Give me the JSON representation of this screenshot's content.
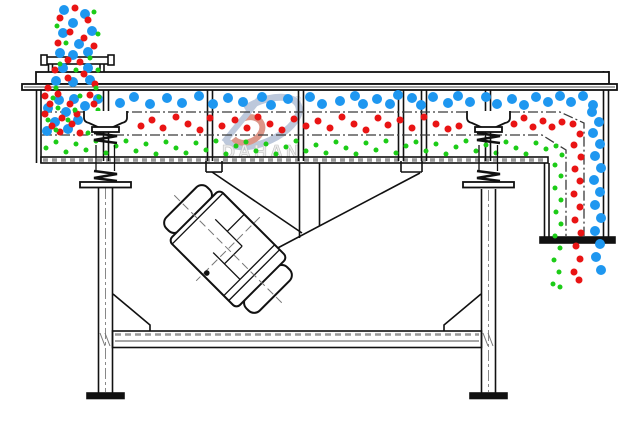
{
  "watermark": {
    "brand": "DAHAN",
    "registered_mark": "®"
  },
  "colors": {
    "blue": "#1e97f0",
    "red": "#e91414",
    "green": "#1ccc17",
    "line": "#111111",
    "hatch_gray": "#999999",
    "wm_blue": "#b6c3d8",
    "wm_red": "#d98b7c",
    "wm_text": "#ececec"
  },
  "particles": {
    "groups": [
      {
        "id": "feed-stream-blue",
        "color": "blue",
        "r": 5,
        "points": [
          [
            64,
            10
          ],
          [
            85,
            14
          ],
          [
            73,
            23
          ],
          [
            92,
            31
          ],
          [
            63,
            33
          ],
          [
            79,
            44
          ],
          [
            60,
            53
          ],
          [
            73,
            55
          ],
          [
            88,
            52
          ],
          [
            63,
            68
          ],
          [
            88,
            68
          ],
          [
            56,
            81
          ],
          [
            73,
            82
          ],
          [
            90,
            80
          ]
        ]
      },
      {
        "id": "feed-stream-red",
        "color": "red",
        "r": 3.5,
        "points": [
          [
            75,
            8
          ],
          [
            60,
            18
          ],
          [
            88,
            20
          ],
          [
            70,
            32
          ],
          [
            84,
            38
          ],
          [
            58,
            43
          ],
          [
            94,
            46
          ],
          [
            68,
            60
          ],
          [
            80,
            62
          ],
          [
            55,
            70
          ],
          [
            84,
            74
          ],
          [
            68,
            78
          ],
          [
            95,
            84
          ],
          [
            48,
            88
          ]
        ]
      },
      {
        "id": "feed-stream-green",
        "color": "green",
        "r": 2.5,
        "points": [
          [
            94,
            12
          ],
          [
            57,
            26
          ],
          [
            98,
            34
          ],
          [
            66,
            43
          ],
          [
            90,
            58
          ],
          [
            60,
            64
          ],
          [
            98,
            70
          ],
          [
            76,
            70
          ],
          [
            56,
            88
          ],
          [
            96,
            88
          ]
        ]
      },
      {
        "id": "feed-zone-blue",
        "color": "blue",
        "r": 5,
        "points": [
          [
            59,
            100
          ],
          [
            74,
            99
          ],
          [
            48,
            108
          ],
          [
            66,
            112
          ],
          [
            85,
            106
          ],
          [
            55,
            122
          ],
          [
            78,
            120
          ],
          [
            68,
            129
          ],
          [
            47,
            131
          ],
          [
            98,
            99
          ]
        ]
      },
      {
        "id": "feed-zone-red",
        "color": "red",
        "r": 3.5,
        "points": [
          [
            45,
            96
          ],
          [
            58,
            94
          ],
          [
            90,
            95
          ],
          [
            50,
            104
          ],
          [
            70,
            104
          ],
          [
            94,
            104
          ],
          [
            45,
            114
          ],
          [
            62,
            118
          ],
          [
            77,
            114
          ],
          [
            52,
            126
          ],
          [
            72,
            124
          ],
          [
            60,
            132
          ],
          [
            80,
            133
          ]
        ]
      },
      {
        "id": "feed-zone-green",
        "color": "green",
        "r": 2.5,
        "points": [
          [
            53,
            98
          ],
          [
            80,
            96
          ],
          [
            99,
            97
          ],
          [
            58,
            108
          ],
          [
            75,
            110
          ],
          [
            98,
            110
          ],
          [
            48,
            120
          ],
          [
            68,
            120
          ],
          [
            56,
            130
          ],
          [
            88,
            133
          ],
          [
            100,
            130
          ]
        ]
      },
      {
        "id": "top-deck-blue",
        "color": "blue",
        "r": 5,
        "points": [
          [
            120,
            103
          ],
          [
            134,
            97
          ],
          [
            150,
            104
          ],
          [
            167,
            98
          ],
          [
            182,
            103
          ],
          [
            199,
            96
          ],
          [
            213,
            104
          ],
          [
            228,
            98
          ],
          [
            243,
            102
          ],
          [
            262,
            97
          ],
          [
            271,
            105
          ],
          [
            288,
            99
          ],
          [
            310,
            97
          ],
          [
            322,
            104
          ],
          [
            340,
            101
          ],
          [
            355,
            96
          ],
          [
            363,
            104
          ],
          [
            377,
            99
          ],
          [
            390,
            104
          ],
          [
            398,
            95
          ],
          [
            412,
            98
          ],
          [
            421,
            105
          ],
          [
            433,
            97
          ],
          [
            448,
            103
          ],
          [
            458,
            96
          ],
          [
            470,
            102
          ],
          [
            486,
            97
          ],
          [
            497,
            104
          ],
          [
            512,
            99
          ],
          [
            524,
            105
          ],
          [
            536,
            97
          ],
          [
            548,
            102
          ],
          [
            560,
            96
          ],
          [
            571,
            102
          ],
          [
            583,
            96
          ],
          [
            593,
            105
          ]
        ]
      },
      {
        "id": "middle-deck-red",
        "color": "red",
        "r": 3.5,
        "points": [
          [
            141,
            126
          ],
          [
            152,
            120
          ],
          [
            163,
            128
          ],
          [
            176,
            117
          ],
          [
            188,
            124
          ],
          [
            200,
            130
          ],
          [
            210,
            118
          ],
          [
            222,
            126
          ],
          [
            235,
            120
          ],
          [
            247,
            128
          ],
          [
            258,
            117
          ],
          [
            270,
            124
          ],
          [
            282,
            130
          ],
          [
            294,
            119
          ],
          [
            306,
            126
          ],
          [
            318,
            121
          ],
          [
            330,
            128
          ],
          [
            342,
            117
          ],
          [
            354,
            124
          ],
          [
            366,
            130
          ],
          [
            378,
            118
          ],
          [
            388,
            125
          ],
          [
            400,
            120
          ],
          [
            412,
            128
          ],
          [
            424,
            117
          ],
          [
            436,
            124
          ],
          [
            448,
            129
          ],
          [
            459,
            126
          ],
          [
            514,
            124
          ],
          [
            524,
            118
          ],
          [
            533,
            127
          ],
          [
            543,
            121
          ],
          [
            552,
            127
          ],
          [
            562,
            122
          ]
        ]
      },
      {
        "id": "bottom-deck-green",
        "color": "green",
        "r": 2.5,
        "points": [
          [
            46,
            148
          ],
          [
            56,
            142
          ],
          [
            66,
            152
          ],
          [
            76,
            144
          ],
          [
            86,
            150
          ],
          [
            96,
            141
          ],
          [
            106,
            153
          ],
          [
            116,
            146
          ],
          [
            126,
            141
          ],
          [
            136,
            151
          ],
          [
            146,
            144
          ],
          [
            156,
            154
          ],
          [
            166,
            142
          ],
          [
            176,
            148
          ],
          [
            186,
            153
          ],
          [
            196,
            143
          ],
          [
            206,
            150
          ],
          [
            216,
            141
          ],
          [
            226,
            154
          ],
          [
            236,
            146
          ],
          [
            246,
            142
          ],
          [
            256,
            151
          ],
          [
            266,
            144
          ],
          [
            276,
            154
          ],
          [
            286,
            147
          ],
          [
            296,
            141
          ],
          [
            306,
            151
          ],
          [
            316,
            145
          ],
          [
            326,
            153
          ],
          [
            336,
            142
          ],
          [
            346,
            148
          ],
          [
            356,
            154
          ],
          [
            366,
            143
          ],
          [
            376,
            150
          ],
          [
            386,
            141
          ],
          [
            396,
            153
          ],
          [
            406,
            146
          ],
          [
            416,
            142
          ],
          [
            426,
            151
          ],
          [
            436,
            144
          ],
          [
            446,
            154
          ],
          [
            456,
            147
          ],
          [
            466,
            141
          ],
          [
            476,
            151
          ],
          [
            486,
            145
          ],
          [
            496,
            153
          ],
          [
            506,
            142
          ],
          [
            516,
            148
          ],
          [
            526,
            154
          ],
          [
            536,
            143
          ],
          [
            546,
            149
          ]
        ]
      },
      {
        "id": "discharge-blue",
        "color": "blue",
        "r": 5,
        "points": [
          [
            592,
            112
          ],
          [
            599,
            122
          ],
          [
            593,
            133
          ],
          [
            600,
            144
          ],
          [
            595,
            156
          ],
          [
            601,
            168
          ],
          [
            594,
            180
          ],
          [
            600,
            192
          ],
          [
            595,
            205
          ],
          [
            601,
            218
          ],
          [
            595,
            231
          ],
          [
            600,
            244
          ],
          [
            596,
            257
          ],
          [
            601,
            270
          ]
        ]
      },
      {
        "id": "discharge-red",
        "color": "red",
        "r": 3.5,
        "points": [
          [
            573,
            124
          ],
          [
            580,
            134
          ],
          [
            574,
            145
          ],
          [
            581,
            157
          ],
          [
            575,
            169
          ],
          [
            580,
            181
          ],
          [
            574,
            194
          ],
          [
            580,
            207
          ],
          [
            575,
            220
          ],
          [
            581,
            233
          ],
          [
            576,
            246
          ],
          [
            580,
            259
          ],
          [
            574,
            272
          ],
          [
            579,
            280
          ]
        ]
      },
      {
        "id": "discharge-green",
        "color": "green",
        "r": 2.5,
        "points": [
          [
            556,
            146
          ],
          [
            562,
            155
          ],
          [
            555,
            165
          ],
          [
            561,
            176
          ],
          [
            555,
            188
          ],
          [
            561,
            200
          ],
          [
            556,
            212
          ],
          [
            561,
            224
          ],
          [
            555,
            236
          ],
          [
            560,
            248
          ],
          [
            554,
            260
          ],
          [
            559,
            272
          ],
          [
            553,
            284
          ],
          [
            560,
            287
          ]
        ]
      }
    ]
  }
}
